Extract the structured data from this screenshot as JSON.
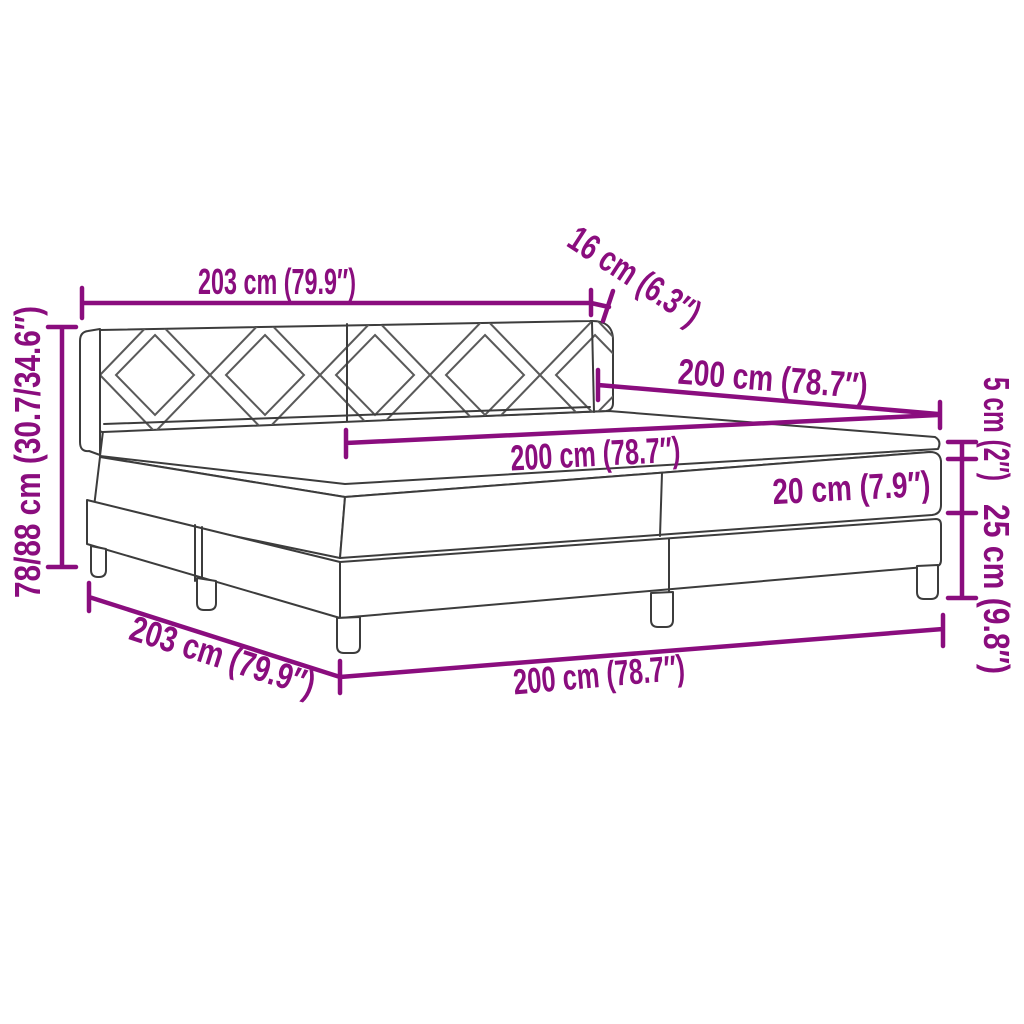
{
  "diagram": {
    "title": "Box spring bed with headboard and mattress — dimension diagram",
    "type": "product-dimension-line-drawing",
    "colors": {
      "dimension_accent": "#8A0D7E",
      "bed_outline": "#3C3C3C",
      "pattern_line": "#5A5A5A",
      "background": "#FFFFFF"
    },
    "labels": {
      "headboard_width": {
        "text": "203 cm (79.9″)",
        "value_cm": "203",
        "value_in": "79.9"
      },
      "headboard_depth": {
        "text": "16 cm (6.3″)",
        "value_cm": "16",
        "value_in": "6.3"
      },
      "bed_length_upper": {
        "text": "200 cm (78.7″)",
        "value_cm": "200",
        "value_in": "78.7"
      },
      "mattress_length": {
        "text": "200 cm (78.7″)",
        "value_cm": "200",
        "value_in": "78.7"
      },
      "topper_height": {
        "text": "5 cm (2″)",
        "value_cm": "5",
        "value_in": "2"
      },
      "mattress_height": {
        "text": "20 cm (7.9″)",
        "value_cm": "20",
        "value_in": "7.9"
      },
      "base_height": {
        "text": "25 cm (9.8″)",
        "value_cm": "25",
        "value_in": "9.8"
      },
      "headboard_height": {
        "text": "78/88 cm (30.7/34.6″)",
        "value_cm": "78/88",
        "value_in": "30.7/34.6"
      },
      "frame_width": {
        "text": "203 cm (79.9″)",
        "value_cm": "203",
        "value_in": "79.9"
      },
      "base_length": {
        "text": "200 cm (78.7″)",
        "value_cm": "200",
        "value_in": "78.7"
      }
    }
  }
}
